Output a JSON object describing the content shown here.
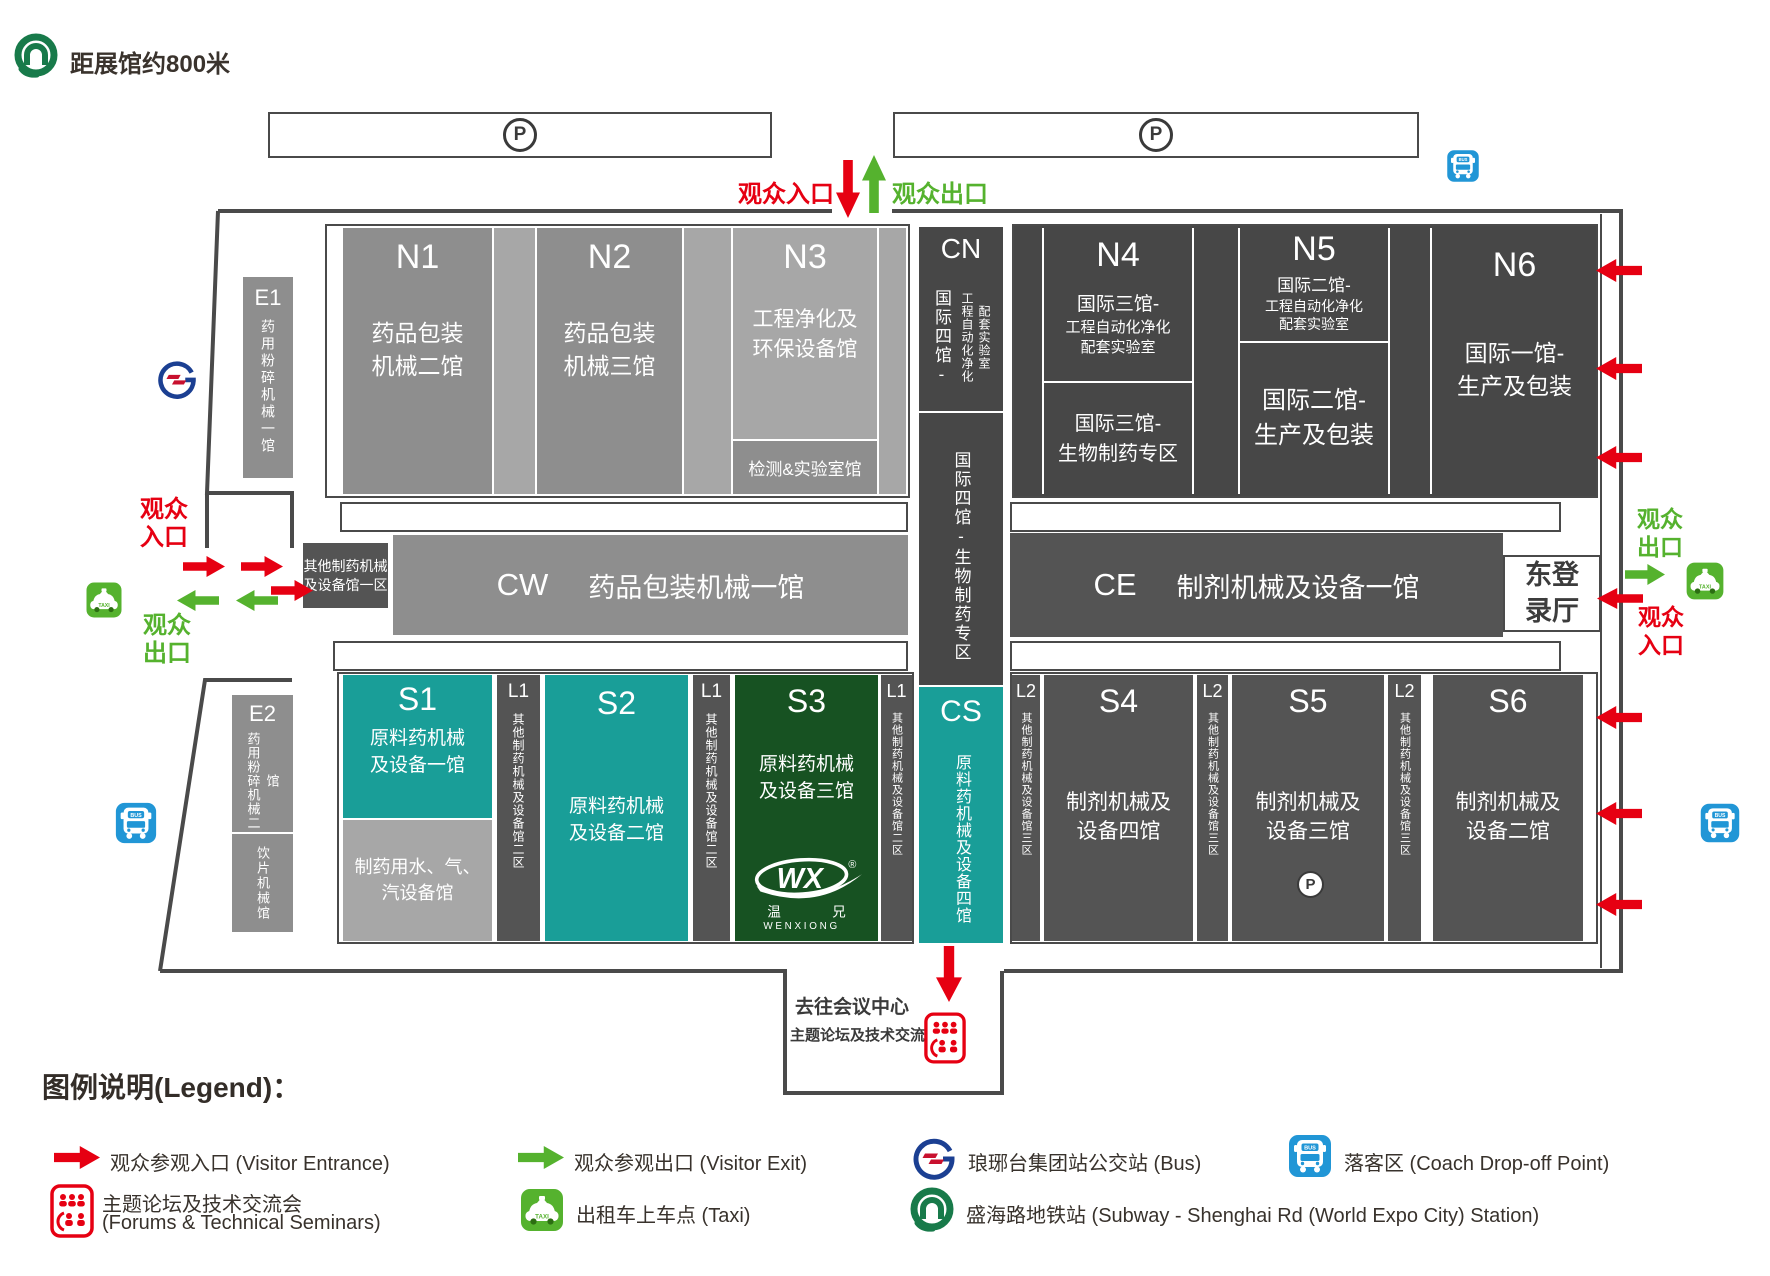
{
  "header": {
    "distance_note": "距展馆约800米"
  },
  "parking": {
    "p": "P"
  },
  "gates": {
    "north_in": "观众入口",
    "north_out": "观众出口",
    "west_in": "观众\n入口",
    "west_out": "观众\n出口",
    "east_out": "观众\n出口",
    "east_in": "观众\n入口"
  },
  "halls": {
    "n1": {
      "code": "N1",
      "name": "药品包装\n机械二馆"
    },
    "n2": {
      "code": "N2",
      "name": "药品包装\n机械三馆"
    },
    "n3": {
      "code": "N3",
      "name": "工程净化及\n环保设备馆"
    },
    "lab": {
      "name": "检测&实验室馆"
    },
    "cn": {
      "code": "CN",
      "col1": "国际四馆-",
      "col2": "工程自动化净化\n配套实验室",
      "lower": "国际四馆-生物制药专区"
    },
    "n4": {
      "code": "N4",
      "top1": "国际三馆-",
      "top2": "工程自动化净化\n配套实验室",
      "bottom": "国际三馆-\n生物制药专区"
    },
    "n5": {
      "code": "N5",
      "top1": "国际二馆-",
      "top2": "工程自动化净化\n配套实验室",
      "bottom": "国际二馆-\n生产及包装"
    },
    "n6": {
      "code": "N6",
      "name": "国际一馆-\n生产及包装"
    },
    "e1": {
      "code": "E1",
      "name": "药用粉碎机械一馆"
    },
    "e2": {
      "code": "E2",
      "name": "药用粉碎机械二馆",
      "sub": "饮片机械馆"
    },
    "cw": {
      "code": "CW",
      "name": "药品包装机械一馆"
    },
    "ce": {
      "code": "CE",
      "name": "制剂机械及设备一馆"
    },
    "other1": {
      "name": "其他制药机械\n及设备馆一区"
    },
    "s1": {
      "code": "S1",
      "name": "原料药机械\n及设备一馆"
    },
    "s1sub": {
      "name": "制药用水、气、\n汽设备馆"
    },
    "s2": {
      "code": "S2",
      "name": "原料药机械\n及设备二馆"
    },
    "s3": {
      "code": "S3",
      "name": "原料药机械\n及设备三馆"
    },
    "cs": {
      "code": "CS",
      "name": "原料药机械及设备四馆"
    },
    "s4": {
      "code": "S4",
      "name": "制剂机械及\n设备四馆"
    },
    "s5": {
      "code": "S5",
      "name": "制剂机械及\n设备三馆"
    },
    "s6": {
      "code": "S6",
      "name": "制剂机械及\n设备二馆"
    },
    "l1": {
      "code": "L1",
      "name": "其他制药机械及设备馆二区"
    },
    "l2": {
      "code": "L2",
      "name": "其他制药机械及设备馆三区"
    },
    "east_hall": {
      "name": "东登\n录厅"
    }
  },
  "wx_logo": {
    "wx": "WX",
    "reg": "®",
    "cn1": "温",
    "cn2": "兄",
    "en": "WENXIONG"
  },
  "conference": {
    "title": "去往会议中心",
    "subtitle": "主题论坛及技术交流会"
  },
  "icons": {
    "bus_label": "BUS",
    "taxi_label": "TAXI"
  },
  "legend": {
    "title": "图例说明(Legend)：",
    "entrance": "观众参观入口 (Visitor Entrance)",
    "exit": "观众参观出口 (Visitor Exit)",
    "bus": "琅琊台集团站公交站 (Bus)",
    "coach": "落客区 (Coach Drop-off Point)",
    "forum1": "主题论坛及技术交流会",
    "forum2": "(Forums & Technical Seminars)",
    "taxi": "出租车上车点 (Taxi)",
    "subway": "盛海路地铁站 (Subway - Shenghai Rd (World Expo City) Station)"
  },
  "colors": {
    "red": "#e60012",
    "green": "#55b22e",
    "teal": "#199e98",
    "dark_green": "#175222",
    "dark": "#474747",
    "mid": "#545454",
    "gray": "#8e8e8e",
    "light": "#a7a7a7",
    "blue": "#2196d6",
    "subway_green": "#187a4a",
    "lyt_blue": "#1b3f92"
  }
}
